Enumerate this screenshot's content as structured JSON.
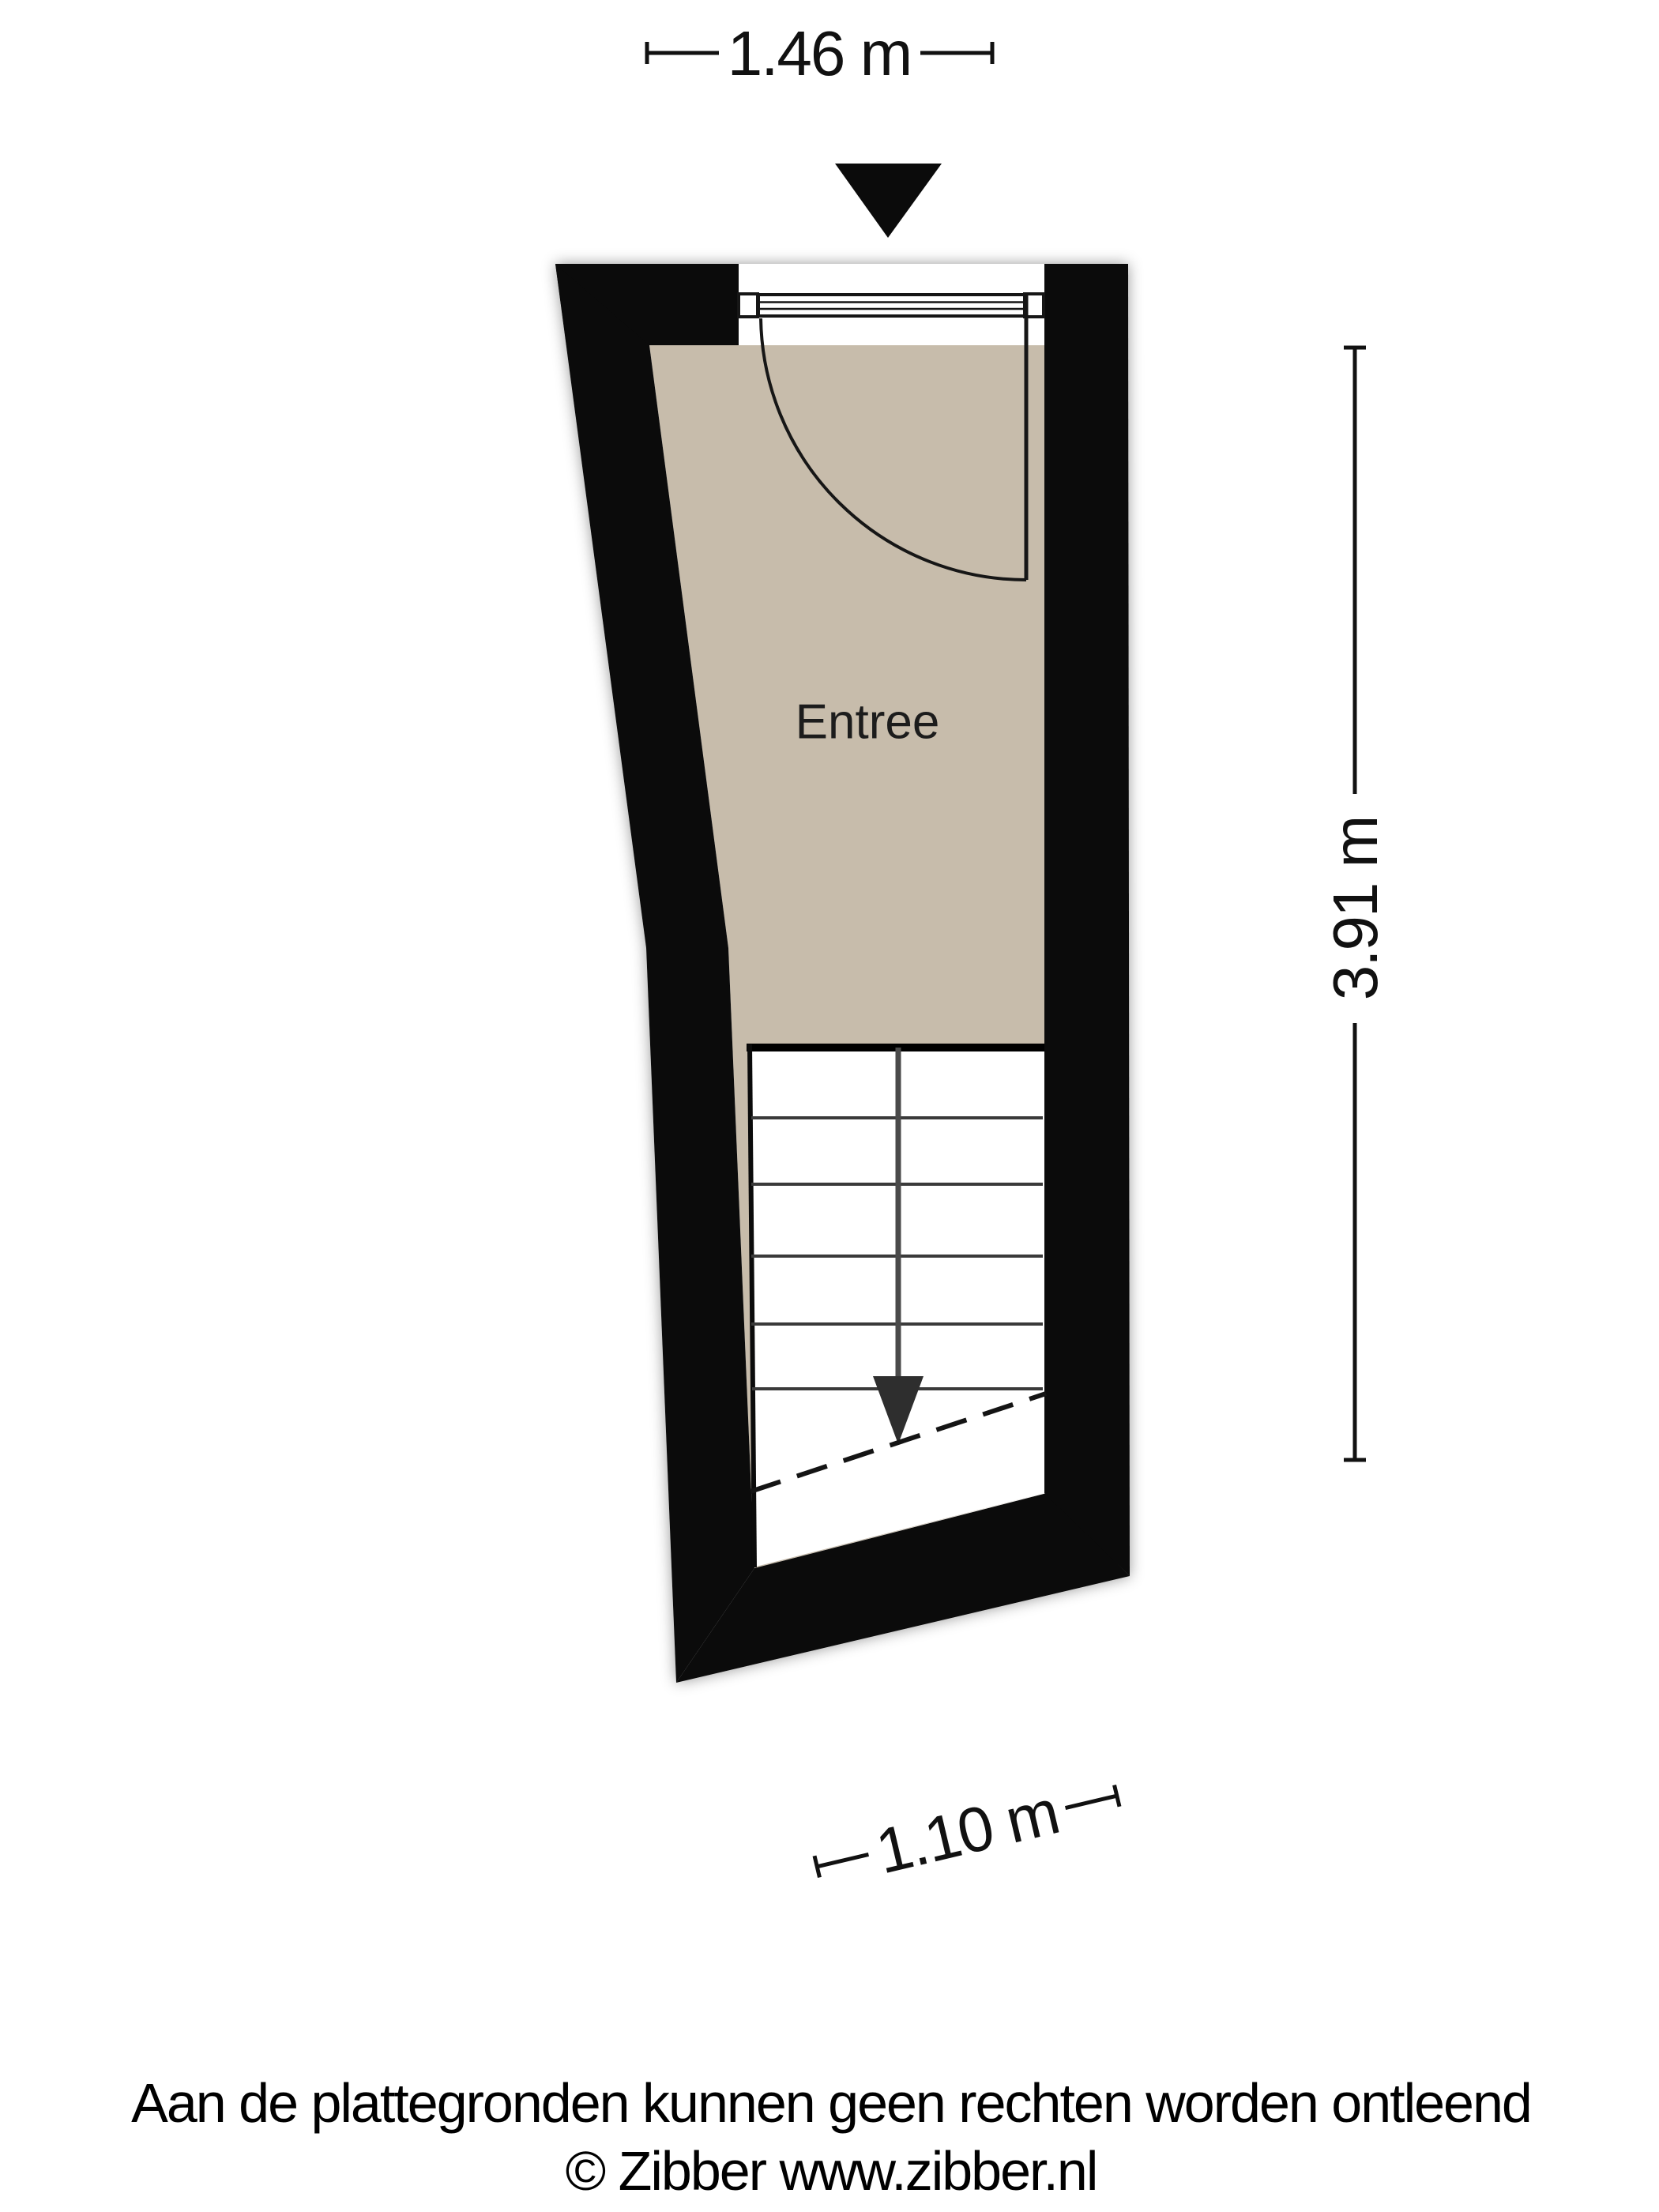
{
  "floor_plan": {
    "room_label": "Entree",
    "dimensions": {
      "width_top": "1.46 m",
      "height_right": "3.91 m",
      "width_bottom": "1.10 m"
    },
    "icons": {
      "entrance_arrow": "entrance-arrow-icon",
      "stairs_direction_arrow": "stairs-down-arrow-icon"
    },
    "colors": {
      "wall": "#0b0b0b",
      "room_fill": "#c7bcab",
      "stair_fill": "#ffffff",
      "background": "#ffffff",
      "line": "#111111"
    }
  },
  "footer": {
    "disclaimer": "Aan de plattegronden kunnen geen rechten worden ontleend",
    "copyright": "© Zibber www.zibber.nl"
  }
}
